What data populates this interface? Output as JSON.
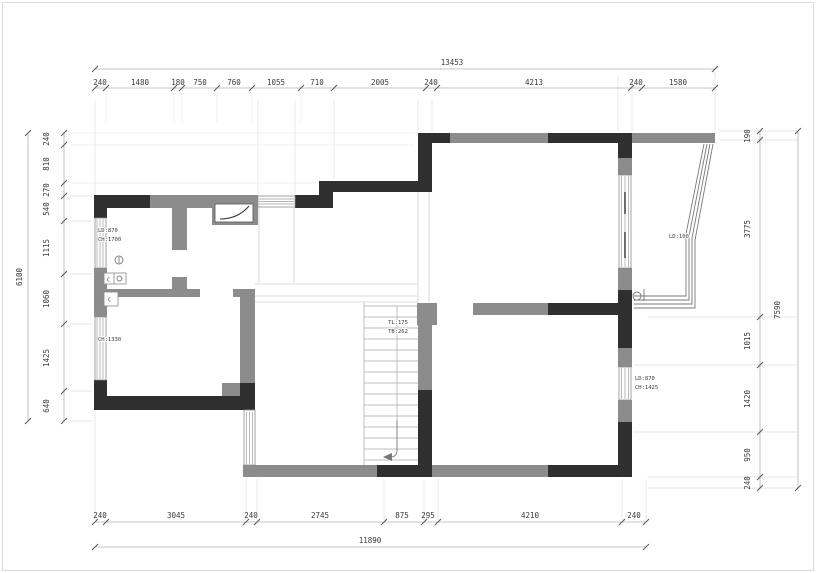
{
  "drawing_type": "floor-plan",
  "dims": {
    "top": {
      "total": "13453",
      "segments": [
        "240",
        "1480",
        "180",
        "750",
        "760",
        "1055",
        "710",
        "2005",
        "240",
        "4213",
        "240",
        "1580"
      ]
    },
    "bottom": {
      "total": "11890",
      "segments": [
        "240",
        "3045",
        "240",
        "2745",
        "875",
        "295",
        "4210",
        "240"
      ]
    },
    "left": {
      "total": "6100",
      "segments": [
        "240",
        "810",
        "270",
        "540",
        "1115",
        "1060",
        "1425",
        "640"
      ]
    },
    "right": {
      "total": "7590",
      "segments": [
        "190",
        "3775",
        "1015",
        "1420",
        "950",
        "240"
      ]
    }
  },
  "annotations": {
    "window_left_upper": {
      "line1": "LD:870",
      "line2": "CH:1700"
    },
    "window_left_lower": {
      "line1": "CH:1330"
    },
    "stair": {
      "line1": "TL:175",
      "line2": "TB:262"
    },
    "window_right_lower": {
      "line1": "LD:870",
      "line2": "CH:1425"
    },
    "bay_window": {
      "line1": "LD:100"
    },
    "meter_box_1": "C",
    "meter_box_2": "C"
  },
  "colors": {
    "wall_dark": "#2f2f2f",
    "wall_gray": "#8c8c8c",
    "dimension_line": "#b3b3b3",
    "dimension_text": "#3a3a3a",
    "background": "#ffffff"
  }
}
